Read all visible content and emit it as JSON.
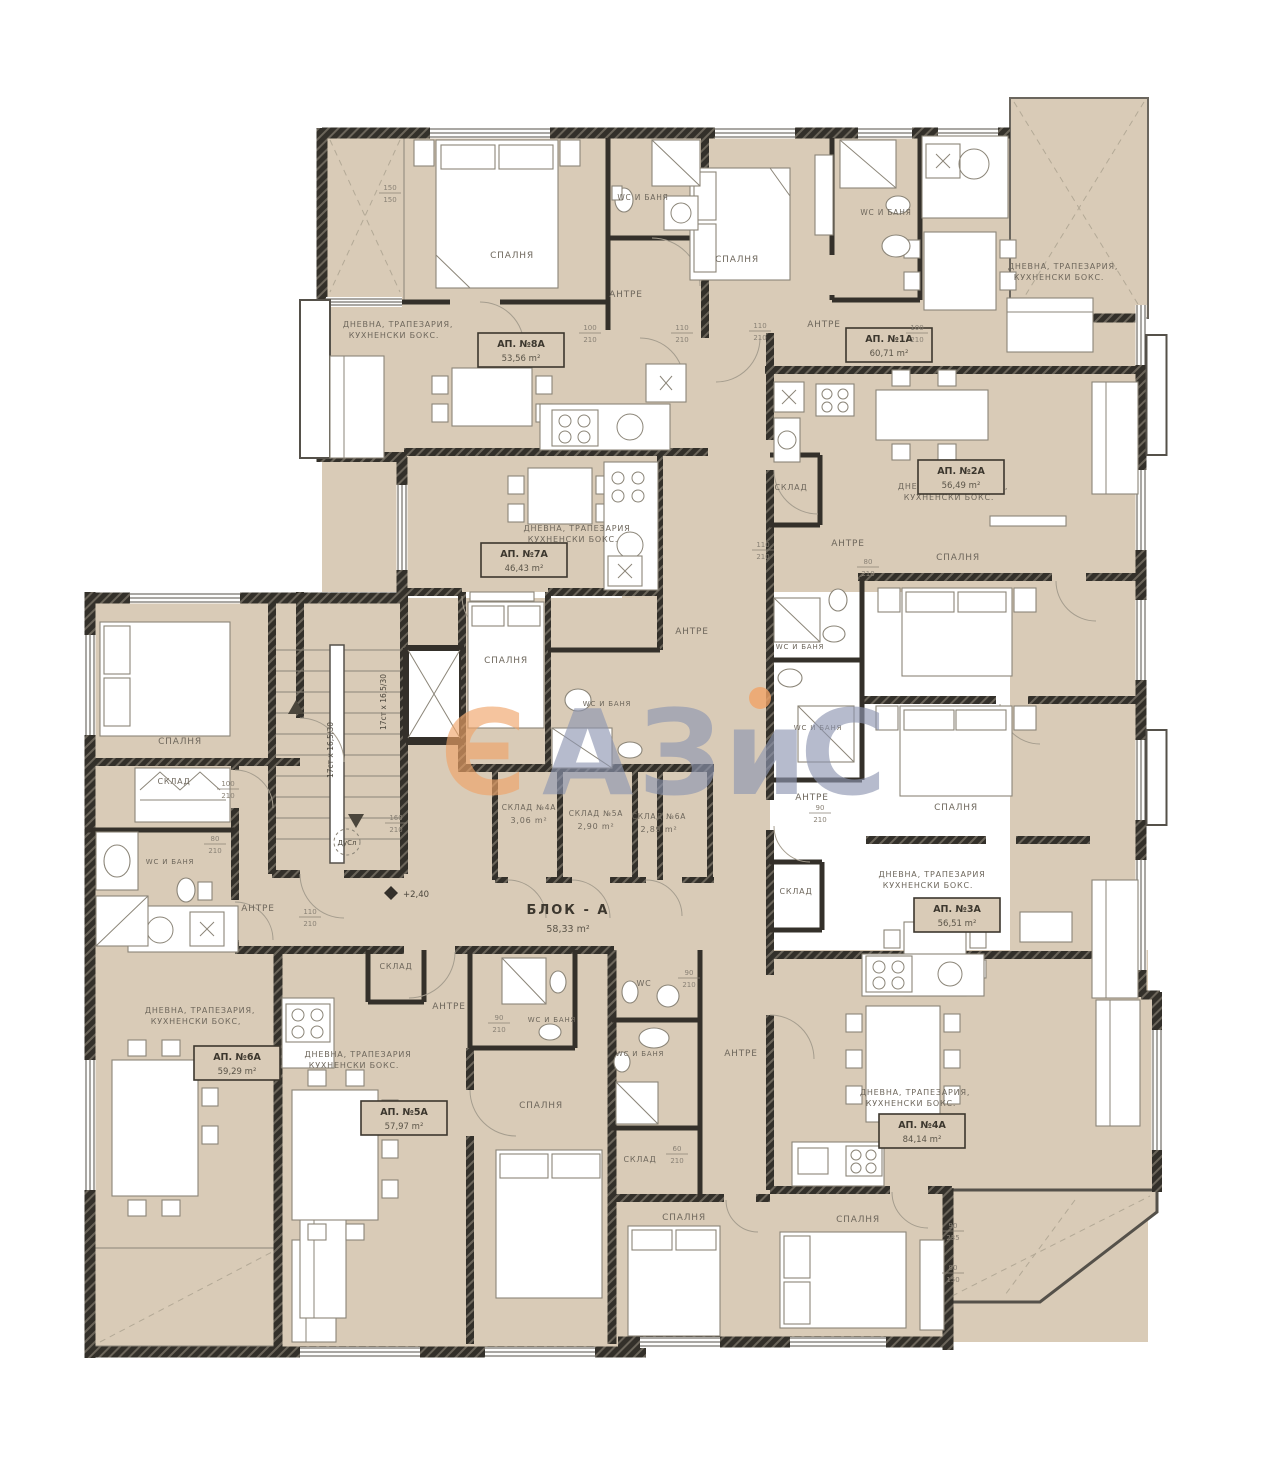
{
  "block": {
    "name": "БЛОК - А",
    "area": "58,33 m²"
  },
  "level_mark": "+2,40",
  "shaft_label": "ДуСл",
  "stairs_label": "17ст х 16,5/30",
  "watermark": {
    "char_o": "Є",
    "char_a": "А",
    "char_z": "З",
    "char_i": "и",
    "char_c": "С",
    "orange": "#f1a468",
    "blue": "#8e96b2"
  },
  "colors": {
    "floor": "#d9cbb7",
    "wall": "#34302a",
    "label": "#6e675c"
  },
  "apartments": [
    {
      "name": "АП. №8А",
      "area": "53,56 m²",
      "x": 478,
      "y": 333
    },
    {
      "name": "АП. №1А",
      "area": "60,71 m²",
      "x": 846,
      "y": 328
    },
    {
      "name": "АП. №2А",
      "area": "56,49 m²",
      "x": 918,
      "y": 460
    },
    {
      "name": "АП. №7А",
      "area": "46,43 m²",
      "x": 481,
      "y": 543
    },
    {
      "name": "АП. №3А",
      "area": "56,51 m²",
      "x": 914,
      "y": 898
    },
    {
      "name": "АП. №6А",
      "area": "59,29 m²",
      "x": 194,
      "y": 1046
    },
    {
      "name": "АП. №5А",
      "area": "57,97 m²",
      "x": 361,
      "y": 1101
    },
    {
      "name": "АП. №4А",
      "area": "84,14 m²",
      "x": 879,
      "y": 1114
    }
  ],
  "storages": [
    {
      "name": "СКЛАД №4А",
      "area": "3,06 m²",
      "x": 529,
      "y": 810
    },
    {
      "name": "СКЛАД №5А",
      "area": "2,90 m²",
      "x": 596,
      "y": 816
    },
    {
      "name": "СКЛАД №6А",
      "area": "2,89 m²",
      "x": 659,
      "y": 819
    }
  ],
  "rooms": [
    {
      "t": "СПАЛНЯ",
      "x": 512,
      "y": 258
    },
    {
      "t": "АНТРЕ",
      "x": 626,
      "y": 297
    },
    {
      "t": "WC И БАНЯ",
      "x": 643,
      "y": 200,
      "fs": 7.5
    },
    {
      "t": "ДНЕВНА, ТРАПЕЗАРИЯ,",
      "x": 398,
      "y": 327,
      "fs": 8
    },
    {
      "t": "КУХНЕНСКИ БОКС.",
      "x": 394,
      "y": 338,
      "fs": 8
    },
    {
      "t": "СПАЛНЯ",
      "x": 737,
      "y": 262
    },
    {
      "t": "WC И БАНЯ",
      "x": 886,
      "y": 215,
      "fs": 7.5
    },
    {
      "t": "АНТРЕ",
      "x": 824,
      "y": 327
    },
    {
      "t": "ДНЕВНА, ТРАПЕЗАРИЯ,",
      "x": 1063,
      "y": 269,
      "fs": 8
    },
    {
      "t": "КУХНЕНСКИ БОКС.",
      "x": 1059,
      "y": 280,
      "fs": 8
    },
    {
      "t": "ДНЕВНА, ТРАПЕЗАРИЯ,",
      "x": 953,
      "y": 489,
      "fs": 8
    },
    {
      "t": "КУХНЕНСКИ БОКС.",
      "x": 949,
      "y": 500,
      "fs": 8
    },
    {
      "t": "АНТРЕ",
      "x": 848,
      "y": 546
    },
    {
      "t": "СКЛАД",
      "x": 791,
      "y": 490,
      "fs": 8
    },
    {
      "t": "СПАЛНЯ",
      "x": 958,
      "y": 560
    },
    {
      "t": "ДНЕВНА, ТРАПЕЗАРИЯ",
      "x": 577,
      "y": 531,
      "fs": 8
    },
    {
      "t": "КУХНЕНСКИ БОКС.",
      "x": 573,
      "y": 542,
      "fs": 8
    },
    {
      "t": "СПАЛНЯ",
      "x": 506,
      "y": 663
    },
    {
      "t": "АНТРЕ",
      "x": 692,
      "y": 634
    },
    {
      "t": "WC И БАНЯ",
      "x": 607,
      "y": 706,
      "fs": 7
    },
    {
      "t": "WC И БАНЯ",
      "x": 800,
      "y": 649,
      "fs": 7
    },
    {
      "t": "WC И БАНЯ",
      "x": 818,
      "y": 730,
      "fs": 7
    },
    {
      "t": "АНТРЕ",
      "x": 812,
      "y": 800
    },
    {
      "t": "СКЛАД",
      "x": 796,
      "y": 894,
      "fs": 8
    },
    {
      "t": "ДНЕВНА, ТРАПЕЗАРИЯ",
      "x": 932,
      "y": 877,
      "fs": 8
    },
    {
      "t": "КУХНЕНСКИ БОКС.",
      "x": 928,
      "y": 888,
      "fs": 8
    },
    {
      "t": "СПАЛНЯ",
      "x": 956,
      "y": 810
    },
    {
      "t": "СПАЛНЯ",
      "x": 180,
      "y": 744
    },
    {
      "t": "СКЛАД",
      "x": 174,
      "y": 784,
      "fs": 8
    },
    {
      "t": "WC И БАНЯ",
      "x": 170,
      "y": 864,
      "fs": 7
    },
    {
      "t": "АНТРЕ",
      "x": 258,
      "y": 911
    },
    {
      "t": "ДНЕВНА, ТРАПЕЗАРИЯ,",
      "x": 200,
      "y": 1013,
      "fs": 8
    },
    {
      "t": "КУХНЕНСКИ БОКС,",
      "x": 196,
      "y": 1024,
      "fs": 8
    },
    {
      "t": "ДНЕВНА, ТРАПЕЗАРИЯ",
      "x": 358,
      "y": 1057,
      "fs": 8
    },
    {
      "t": "КУХНЕНСКИ БОКС.",
      "x": 354,
      "y": 1068,
      "fs": 8
    },
    {
      "t": "АНТРЕ",
      "x": 449,
      "y": 1009
    },
    {
      "t": "WC И БАНЯ",
      "x": 552,
      "y": 1022,
      "fs": 7
    },
    {
      "t": "WC",
      "x": 644,
      "y": 986,
      "fs": 8
    },
    {
      "t": "WC И БАНЯ",
      "x": 640,
      "y": 1056,
      "fs": 7
    },
    {
      "t": "АНТРЕ",
      "x": 741,
      "y": 1056
    },
    {
      "t": "СКЛАД",
      "x": 640,
      "y": 1162,
      "fs": 8
    },
    {
      "t": "СКЛАД",
      "x": 396,
      "y": 969,
      "fs": 8
    },
    {
      "t": "СПАЛНЯ",
      "x": 541,
      "y": 1108
    },
    {
      "t": "СПАЛНЯ",
      "x": 684,
      "y": 1220
    },
    {
      "t": "СПАЛНЯ",
      "x": 858,
      "y": 1222
    },
    {
      "t": "ДНЕВНА, ТРАПЕЗАРИЯ,",
      "x": 915,
      "y": 1095,
      "fs": 8
    },
    {
      "t": "КУХНЕНСКИ БОКС.",
      "x": 911,
      "y": 1106,
      "fs": 8
    }
  ],
  "dims": [
    {
      "a": "100",
      "b": "210",
      "x": 590,
      "y": 332
    },
    {
      "a": "110",
      "b": "210",
      "x": 682,
      "y": 332
    },
    {
      "a": "110",
      "b": "210",
      "x": 760,
      "y": 330
    },
    {
      "a": "100",
      "b": "210",
      "x": 917,
      "y": 332
    },
    {
      "a": "110",
      "b": "210",
      "x": 763,
      "y": 549
    },
    {
      "a": "80",
      "b": "210",
      "x": 868,
      "y": 566
    },
    {
      "a": "90",
      "b": "210",
      "x": 820,
      "y": 812
    },
    {
      "a": "160",
      "b": "210",
      "x": 396,
      "y": 822
    },
    {
      "a": "110",
      "b": "210",
      "x": 310,
      "y": 916
    },
    {
      "a": "100",
      "b": "210",
      "x": 228,
      "y": 788
    },
    {
      "a": "80",
      "b": "210",
      "x": 215,
      "y": 843
    },
    {
      "a": "90",
      "b": "210",
      "x": 499,
      "y": 1022
    },
    {
      "a": "90",
      "b": "210",
      "x": 689,
      "y": 977
    },
    {
      "a": "60",
      "b": "210",
      "x": 677,
      "y": 1153
    },
    {
      "a": "90",
      "b": "235",
      "x": 953,
      "y": 1230
    },
    {
      "a": "80",
      "b": "150",
      "x": 953,
      "y": 1272
    },
    {
      "a": "150",
      "b": "150",
      "x": 390,
      "y": 192
    }
  ]
}
